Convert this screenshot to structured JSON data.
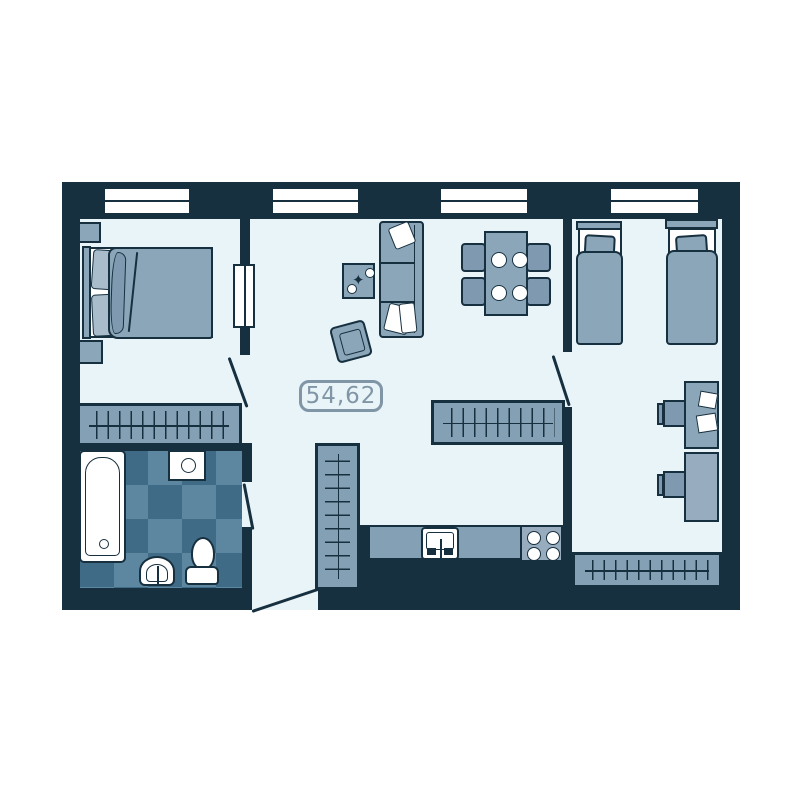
{
  "plan": {
    "area_label": "54,62",
    "colors": {
      "wall": "#17303f",
      "floor": "#e8f4f8",
      "furniture": "#8ba6b9",
      "furniture_dark": "#7f9ab0",
      "closet_fill": "#84a0b4",
      "mattress": "#ffffff",
      "tile_light": "#5d86a0",
      "tile_dark": "#3f6b87",
      "label": "#8095a5",
      "window": "#ffffff",
      "desk_light": "#97adbf",
      "pillow": "#a8bccb"
    }
  }
}
